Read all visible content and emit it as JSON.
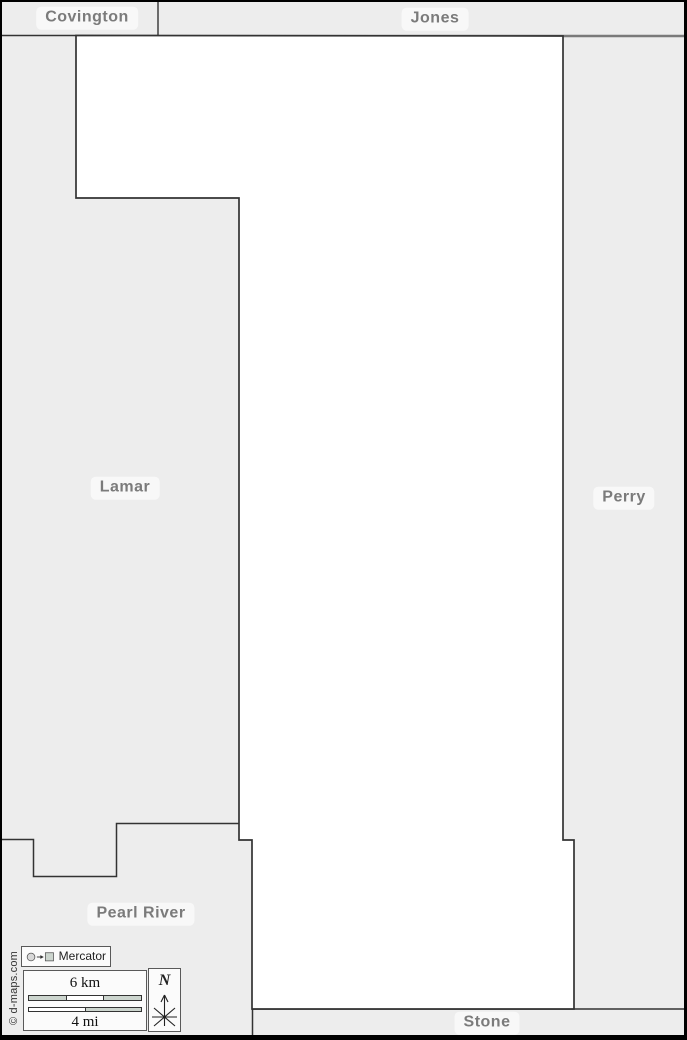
{
  "map": {
    "regions": {
      "covington": "Covington",
      "jones": "Jones",
      "lamar": "Lamar",
      "perry": "Perry",
      "pearl_river": "Pearl River",
      "stone": "Stone"
    },
    "projection_control": {
      "label": "Mercator"
    },
    "scale": {
      "km": "6 km",
      "mi": "4 mi"
    },
    "compass": {
      "north": "N"
    },
    "credit": "© d-maps.com"
  },
  "colors": {
    "frame": "#000000",
    "neighbor_fill": "#ededed",
    "county_fill": "#ffffff",
    "border_line": "#333333",
    "top_line": "#7a7a7a",
    "label_text": "#7b7b7b",
    "label_bg": "#f8f8f8",
    "widget_bg": "#fbfbfb",
    "widget_border": "#595959",
    "scalebar_fill": "#ccd5ce",
    "icon_circle_fill": "#d9d9d9",
    "credit_text": "#333333"
  }
}
